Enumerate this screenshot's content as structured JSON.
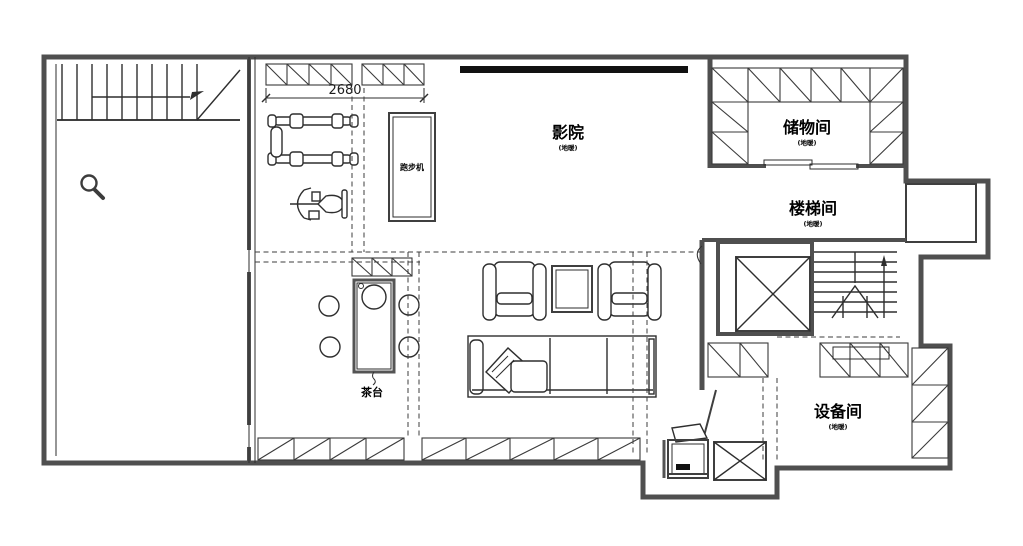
{
  "plan": {
    "rooms": {
      "cinema": {
        "name": "影院",
        "subtitle": "(地暖)"
      },
      "storage": {
        "name": "储物间",
        "subtitle": "(地暖)"
      },
      "stair_hall": {
        "name": "楼梯间",
        "subtitle": "(地暖)"
      },
      "equipment": {
        "name": "设备间",
        "subtitle": "(地暖)"
      }
    },
    "annotations": {
      "tea_counter": "茶台",
      "treadmill": "跑步机",
      "dimension": "2680"
    },
    "colors": {
      "background": "#ffffff",
      "wall": "#4f4f4f",
      "line": "#2e2e2e",
      "screen": "#111111"
    }
  }
}
